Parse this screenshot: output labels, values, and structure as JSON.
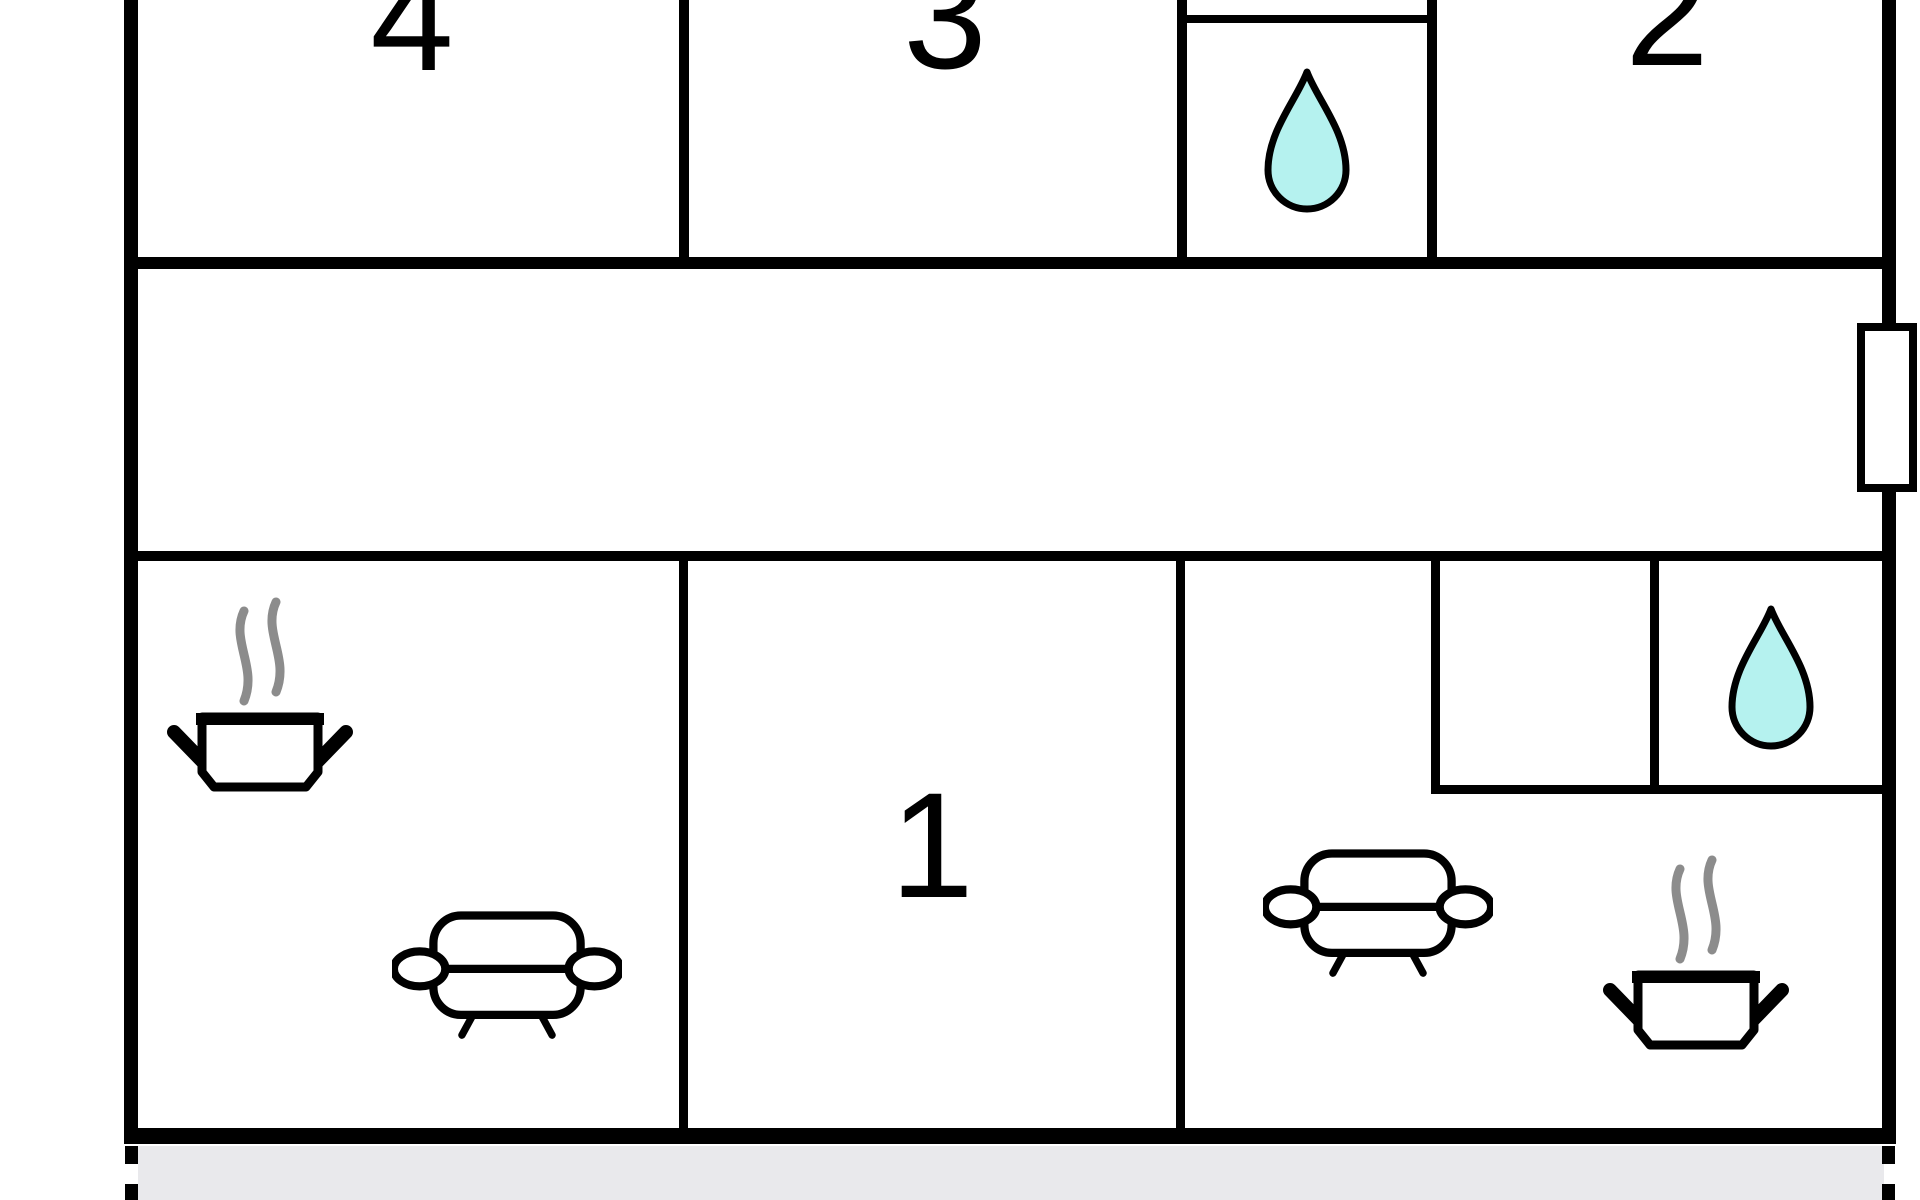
{
  "floorplan": {
    "kind": "apartment floor plan, cropped at top",
    "room_labels": {
      "room1": "1",
      "room2": "2",
      "room3": "3",
      "room4": "4"
    }
  },
  "icons": {
    "water_drop": "teardrop shape = bathroom / water point",
    "cooking_pot": "steaming pot shape = kitchen / stove",
    "sofa": "sofa shape = living / seating area",
    "window": "white break in outer wall = window"
  },
  "colors": {
    "wall": "#000000",
    "water_drop_fill": "#b5f2ef",
    "water_drop_outline": "#000000",
    "steam": "#8c8c8c",
    "terrace_strip": "#e9e9ec",
    "background": "#ffffff",
    "label_text": "#000000"
  }
}
